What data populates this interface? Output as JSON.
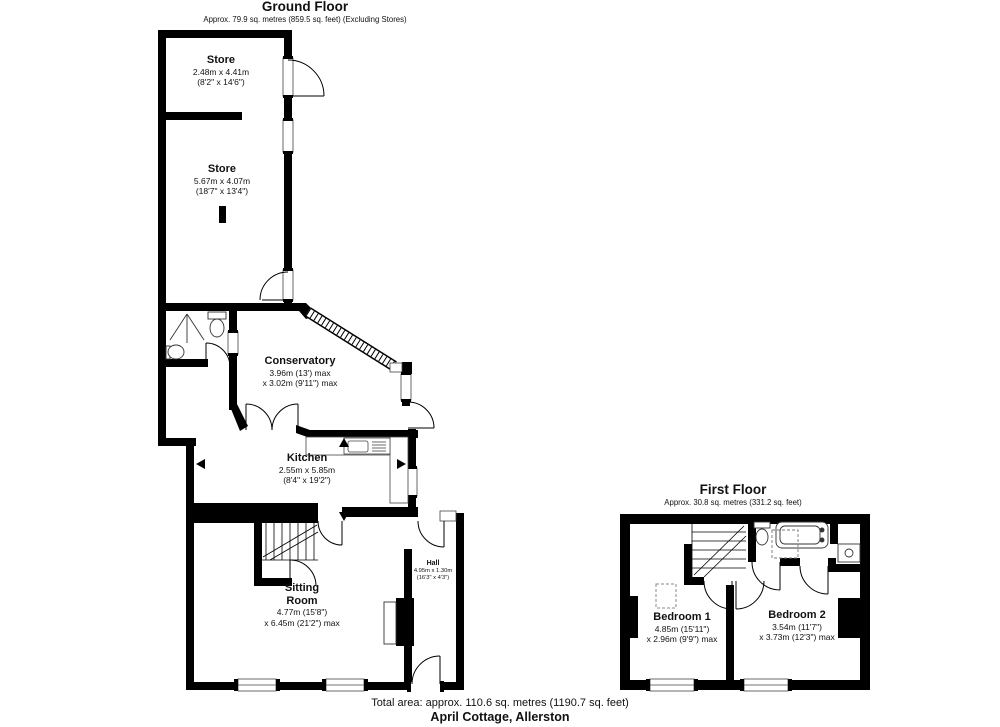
{
  "ground_floor": {
    "title": "Ground Floor",
    "area_note": "Approx. 79.9 sq. metres (859.5 sq. feet) (Excluding Stores)",
    "rooms": {
      "store_top": {
        "name": "Store",
        "dim_metric": "2.48m x 4.41m",
        "dim_imperial": "(8'2\" x 14'6\")"
      },
      "store_main": {
        "name": "Store",
        "dim_metric": "5.67m x 4.07m",
        "dim_imperial": "(18'7\" x 13'4\")"
      },
      "conservatory": {
        "name": "Conservatory",
        "dim_metric": "3.96m (13') max",
        "dim_imperial": "x 3.02m (9'11\") max"
      },
      "kitchen": {
        "name": "Kitchen",
        "dim_metric": "2.55m x 5.85m",
        "dim_imperial": "(8'4\" x 19'2\")"
      },
      "sitting_room": {
        "name": "Sitting Room",
        "dim_metric": "4.77m (15'8\")",
        "dim_imperial": "x 6.45m (21'2\") max"
      },
      "hall": {
        "name": "Hall",
        "dim_metric": "4.95m x 1.30m",
        "dim_imperial": "(16'3\" x 4'3\")"
      }
    }
  },
  "first_floor": {
    "title": "First Floor",
    "area_note": "Approx. 30.8 sq. metres (331.2 sq. feet)",
    "rooms": {
      "bedroom1": {
        "name": "Bedroom 1",
        "dim_metric": "4.85m (15'11\")",
        "dim_imperial": "x 2.96m (9'9\") max"
      },
      "bedroom2": {
        "name": "Bedroom 2",
        "dim_metric": "3.54m (11'7\")",
        "dim_imperial": "x 3.73m (12'3\") max"
      }
    }
  },
  "footer": {
    "total_area": "Total area: approx. 110.6 sq. metres (1190.7 sq. feet)",
    "property_name": "April Cottage, Allerston"
  },
  "colors": {
    "wall": "#000000",
    "background": "#ffffff"
  }
}
